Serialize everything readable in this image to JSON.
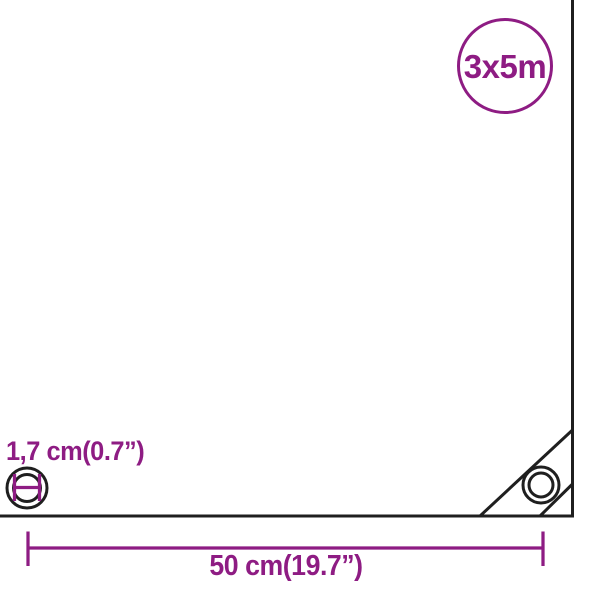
{
  "colors": {
    "accent": "#8E1C83",
    "line": "#1F1F1F",
    "background": "#FFFFFF"
  },
  "badge": {
    "label": "3x5m"
  },
  "eyelet": {
    "diameter_label": "1,7 cm(0.7”)"
  },
  "dimension": {
    "width_label": "50 cm(19.7”)"
  },
  "icons": {
    "size_badge": "circle-outline-badge",
    "eyelet": "concentric-rings-grommet",
    "corner_eyelet": "concentric-rings-grommet",
    "diameter_marker": "h-shaped-dimension-marker",
    "width_dimension": "line-with-end-ticks"
  }
}
